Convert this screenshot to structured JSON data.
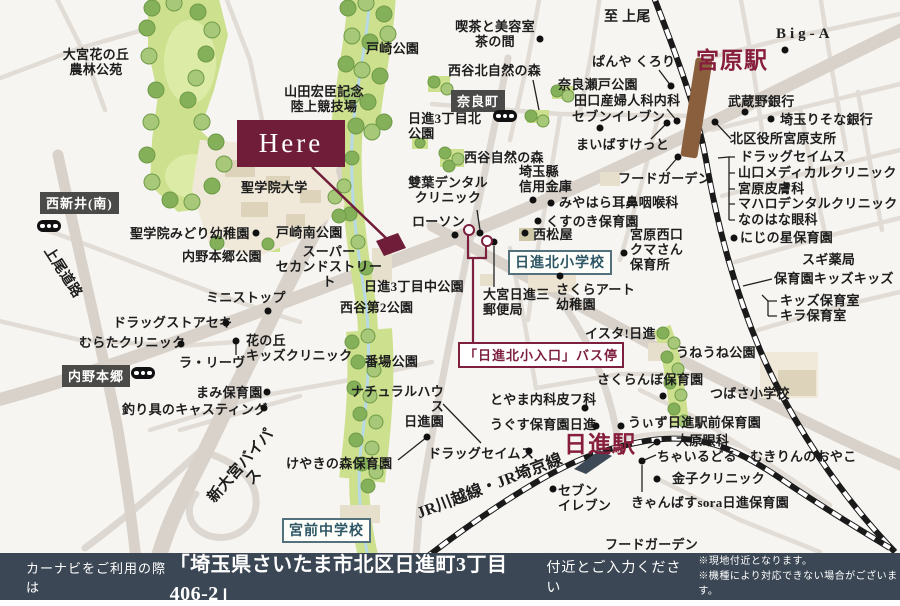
{
  "footer": {
    "prefix": "カーナビをご利用の際は",
    "address": "「埼玉県さいたま市北区日進町3丁目406-2」",
    "suffix": "付近とご入力ください",
    "note1": "※現地付近となります。",
    "note2": "※機種により対応できない場合がございます。"
  },
  "colors": {
    "accent_maroon": "#701d3a",
    "station_red": "#871e3c",
    "footer_bg": "#3b4754",
    "badge_dark": "#4a4a48",
    "school_badge": "#2e5765",
    "park_green": "#cde08d",
    "rail_brown": "#8a5f3e"
  },
  "map": {
    "here_label": "Here",
    "labels": [
      {
        "id": "oomiya-hananooka-park",
        "t": "大宮花の丘\n農林公苑",
        "x": 52,
        "y": 48,
        "w": 88,
        "ta": "center"
      },
      {
        "id": "tozaki-park",
        "t": "戸崎公園",
        "x": 366,
        "y": 42
      },
      {
        "id": "yamada-stadium",
        "t": "山田宏臣記念\n陸上競技場",
        "x": 280,
        "y": 85,
        "w": 88,
        "ta": "center"
      },
      {
        "id": "kissa-chanoma",
        "t": "喫茶と美容室\n茶の間",
        "x": 452,
        "y": 20,
        "w": 86,
        "ta": "center"
      },
      {
        "id": "to-ageo",
        "t": "至 上尾",
        "x": 604,
        "y": 10,
        "fs": 14
      },
      {
        "id": "big-a",
        "t": "Big-A",
        "x": 776,
        "y": 26,
        "fs": 15,
        "ls": 4
      },
      {
        "id": "miyahara-station",
        "t": "宮原駅",
        "x": 696,
        "y": 48,
        "fs": 23,
        "col": "red"
      },
      {
        "id": "nishigaya-kita-forest",
        "t": "西谷北自然の森",
        "x": 448,
        "y": 64
      },
      {
        "id": "panya-kurori",
        "t": "ぱんや くろり",
        "x": 592,
        "y": 55
      },
      {
        "id": "naraseto-park",
        "t": "奈良瀬戸公園",
        "x": 558,
        "y": 78
      },
      {
        "id": "taguchi-clinic",
        "t": "田口産婦人科内科",
        "x": 574,
        "y": 94
      },
      {
        "id": "seven-eleven-miyahara",
        "t": "セブンイレブン",
        "x": 572,
        "y": 110
      },
      {
        "id": "maibasket",
        "t": "まいばすけっと",
        "x": 576,
        "y": 138
      },
      {
        "id": "musashino-bank",
        "t": "武蔵野銀行",
        "x": 728,
        "y": 95
      },
      {
        "id": "risona-bank",
        "t": "埼玉りそな銀行",
        "x": 780,
        "y": 113
      },
      {
        "id": "ward-office-miyahara",
        "t": "北区役所宮原支所",
        "x": 730,
        "y": 132
      },
      {
        "id": "drug-seimusu-miyahara",
        "t": "ドラッグセイムス",
        "x": 740,
        "y": 150
      },
      {
        "id": "yamaguchi-medical",
        "t": "山口メディカルクリニック",
        "x": 738,
        "y": 166
      },
      {
        "id": "miyahara-hifuka",
        "t": "宮原皮膚科",
        "x": 738,
        "y": 182
      },
      {
        "id": "mahalo-dental",
        "t": "マハロデンタルクリニック",
        "x": 738,
        "y": 197
      },
      {
        "id": "nanohana-ganka",
        "t": "なのはな眼科",
        "x": 738,
        "y": 213
      },
      {
        "id": "food-garden-miyahara",
        "t": "フードガーデン",
        "x": 618,
        "y": 172
      },
      {
        "id": "miyahara-jibika",
        "t": "みやはら耳鼻咽喉科",
        "x": 559,
        "y": 196
      },
      {
        "id": "kusunoki-hoikuen",
        "t": "くすのき保育園",
        "x": 546,
        "y": 215
      },
      {
        "id": "nishimatsuya",
        "t": "西松屋",
        "x": 533,
        "y": 228
      },
      {
        "id": "miyahara-nishiguchi-kumasan",
        "t": "宮原西口\nクマさん\n保育所",
        "x": 630,
        "y": 228
      },
      {
        "id": "nijinohoshi-hoikuen",
        "t": "にじの星保育園",
        "x": 740,
        "y": 231
      },
      {
        "id": "sugi-pharmacy",
        "t": "スギ薬局",
        "x": 802,
        "y": 253
      },
      {
        "id": "hoikuen-kids-kids",
        "t": "保育園キッズキッズ",
        "x": 774,
        "y": 272
      },
      {
        "id": "kids-hoikushitsu",
        "t": "キッズ保育室",
        "x": 780,
        "y": 294
      },
      {
        "id": "kira-hoikushitsu",
        "t": "キラ保育室",
        "x": 780,
        "y": 309
      },
      {
        "id": "saitamaken-shinkin",
        "t": "埼玉縣\n信用金庫",
        "x": 519,
        "y": 165
      },
      {
        "id": "nishigaya-forest",
        "t": "西谷自然の森",
        "x": 464,
        "y": 151
      },
      {
        "id": "futaba-dental",
        "t": "雙葉デンタル\nクリニック",
        "x": 406,
        "y": 176,
        "w": 84,
        "ta": "center"
      },
      {
        "id": "lawson",
        "t": "ローソン",
        "x": 412,
        "y": 215
      },
      {
        "id": "nisshin3-kita-park",
        "t": "日進3丁目北\n公園",
        "x": 408,
        "y": 112
      },
      {
        "id": "sakura-art-yochien",
        "t": "さくらアート\n幼稚園",
        "x": 556,
        "y": 283
      },
      {
        "id": "oomiya-nisshin3-post",
        "t": "大宮日進三\n郵便局",
        "x": 483,
        "y": 288
      },
      {
        "id": "ista-nisshin",
        "t": "イスタ!日進",
        "x": 585,
        "y": 327
      },
      {
        "id": "uneune-park",
        "t": "うねうね公園",
        "x": 676,
        "y": 346
      },
      {
        "id": "sakuranbo-hoikuen",
        "t": "さくらんぼ保育園",
        "x": 597,
        "y": 373
      },
      {
        "id": "tsubasa-shogakko",
        "t": "つばさ小学校",
        "x": 710,
        "y": 387
      },
      {
        "id": "with-nisshin-ekimae",
        "t": "うぃず日進駅前保育園",
        "x": 628,
        "y": 416
      },
      {
        "id": "oohara-ganka",
        "t": "大原眼科",
        "x": 676,
        "y": 434
      },
      {
        "id": "childroom-kirin",
        "t": "ちゃいるどるーむきりんのおやこ",
        "x": 657,
        "y": 450
      },
      {
        "id": "kaneko-clinic",
        "t": "金子クリニック",
        "x": 672,
        "y": 472
      },
      {
        "id": "canvas-sora-nisshin",
        "t": "きゃんばすsora日進保育園",
        "x": 631,
        "y": 496
      },
      {
        "id": "food-garden-nisshin",
        "t": "フードガーデン",
        "x": 605,
        "y": 538
      },
      {
        "id": "nisshin-station",
        "t": "日進駅",
        "x": 564,
        "y": 432,
        "fs": 23,
        "col": "red"
      },
      {
        "id": "seven-eleven-nisshin",
        "t": "セブン\nイレブン",
        "x": 558,
        "y": 484
      },
      {
        "id": "toyama-naika-hifuka",
        "t": "とやま内科皮フ科",
        "x": 490,
        "y": 393
      },
      {
        "id": "ugusu-hoikuen-nisshin",
        "t": "うぐす保育園日進",
        "x": 490,
        "y": 418
      },
      {
        "id": "drug-seimusu-nisshin",
        "t": "ドラッグセイムス",
        "x": 428,
        "y": 447
      },
      {
        "id": "natural-house-nisshinen",
        "t": "ナチュラルハウス\n日進園",
        "x": 338,
        "y": 385,
        "w": 106,
        "ta": "right"
      },
      {
        "id": "keyaki-no-mori-hoikuen",
        "t": "けやきの森保育園",
        "x": 286,
        "y": 457
      },
      {
        "id": "banba-park",
        "t": "番場公園",
        "x": 365,
        "y": 355
      },
      {
        "id": "jr-kawagoe-saikyo-line",
        "t": "JR川越線・JR埼京線",
        "x": 390,
        "y": 478,
        "w": 200,
        "ta": "center",
        "fs": 16,
        "rot": -21
      },
      {
        "id": "shin-oomiya-bypass",
        "t": "新大宮バイパス",
        "x": 196,
        "y": 455,
        "w": 104,
        "ta": "center",
        "fs": 15,
        "rot": -49
      },
      {
        "id": "ageo-doro",
        "t": "上尾道路",
        "x": 22,
        "y": 265,
        "w": 80,
        "ta": "center",
        "fs": 14,
        "rot": 57
      },
      {
        "id": "seigakuin-univ",
        "t": "聖学院大学",
        "x": 241,
        "y": 181
      },
      {
        "id": "seigakuin-midori-yochien",
        "t": "聖学院みどり幼稚園",
        "x": 130,
        "y": 227
      },
      {
        "id": "uchino-hongo-park",
        "t": "内野本郷公園",
        "x": 182,
        "y": 250
      },
      {
        "id": "tozaki-minami-park",
        "t": "戸崎南公園",
        "x": 276,
        "y": 226
      },
      {
        "id": "super-second-street",
        "t": "スーパー\nセカンドストリート",
        "x": 270,
        "y": 245,
        "w": 118,
        "ta": "center"
      },
      {
        "id": "nisshin3-naka-park",
        "t": "日進3丁目中公園",
        "x": 364,
        "y": 280
      },
      {
        "id": "nishigaya2-park",
        "t": "西谷第2公園",
        "x": 340,
        "y": 301
      },
      {
        "id": "ministop",
        "t": "ミニストップ",
        "x": 206,
        "y": 291
      },
      {
        "id": "drugstore-seki",
        "t": "ドラッグストアセキ",
        "x": 113,
        "y": 316
      },
      {
        "id": "murata-clinic",
        "t": "むらたクリニック",
        "x": 79,
        "y": 336
      },
      {
        "id": "la-rive",
        "t": "ラ・リーヴ",
        "x": 179,
        "y": 356
      },
      {
        "id": "hananooka-kids-clinic",
        "t": "花の丘\nキッズクリニック",
        "x": 246,
        "y": 334
      },
      {
        "id": "mami-hoikuen",
        "t": "まみ保育園",
        "x": 196,
        "y": 386
      },
      {
        "id": "tsurigu-casting",
        "t": "釣り具のキャスティング",
        "x": 122,
        "y": 403
      }
    ],
    "badges": [
      {
        "id": "naramachi",
        "t": "奈良町",
        "x": 451,
        "y": 90,
        "style": "dark"
      },
      {
        "id": "nishiarai-minami",
        "t": "西新井(南)",
        "x": 40,
        "y": 192,
        "style": "dark"
      },
      {
        "id": "uchino-hongo",
        "t": "内野本郷",
        "x": 62,
        "y": 365,
        "style": "dark"
      },
      {
        "id": "nisshin-kita-elementary",
        "t": "日進北小学校",
        "x": 508,
        "y": 250,
        "style": "school"
      },
      {
        "id": "miyamae-junior-high",
        "t": "宮前中学校",
        "x": 282,
        "y": 518,
        "style": "school"
      },
      {
        "id": "bus-stop-nisshin-kita-iriguchi",
        "t": "「日進北小入口」バス停",
        "x": 458,
        "y": 342,
        "style": "bus"
      }
    ],
    "signals": [
      [
        37,
        220
      ],
      [
        131,
        367
      ],
      [
        493,
        110
      ]
    ],
    "bus_stops": [
      [
        462,
        224
      ],
      [
        480,
        235
      ]
    ],
    "dots": [
      [
        540,
        39
      ],
      [
        785,
        50
      ],
      [
        671,
        86
      ],
      [
        677,
        121
      ],
      [
        600,
        128
      ],
      [
        667,
        123
      ],
      [
        745,
        112
      ],
      [
        771,
        119
      ],
      [
        715,
        122
      ],
      [
        678,
        157
      ],
      [
        551,
        203
      ],
      [
        538,
        221
      ],
      [
        525,
        233
      ],
      [
        533,
        200
      ],
      [
        624,
        253
      ],
      [
        734,
        238
      ],
      [
        560,
        276
      ],
      [
        455,
        235
      ],
      [
        480,
        233
      ],
      [
        494,
        242
      ],
      [
        256,
        233
      ],
      [
        268,
        311
      ],
      [
        226,
        323
      ],
      [
        181,
        344
      ],
      [
        236,
        341
      ],
      [
        267,
        392
      ],
      [
        264,
        408
      ],
      [
        427,
        437
      ],
      [
        529,
        451
      ],
      [
        585,
        408
      ],
      [
        596,
        426
      ],
      [
        663,
        396
      ],
      [
        621,
        426
      ],
      [
        657,
        442
      ],
      [
        657,
        479
      ],
      [
        642,
        461
      ],
      [
        553,
        489
      ]
    ]
  }
}
